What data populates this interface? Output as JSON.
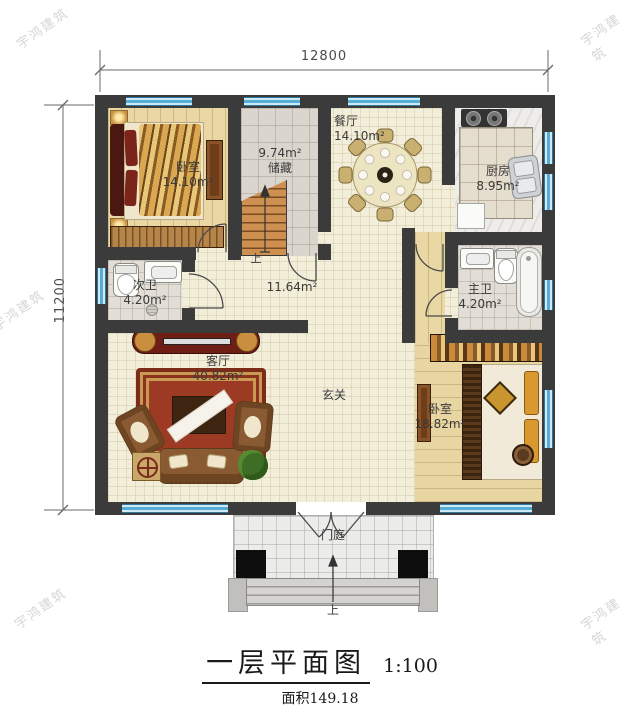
{
  "watermark": {
    "text": "宇鸿建筑"
  },
  "dimensions": {
    "top": "12800",
    "left": "11200"
  },
  "plan": {
    "rooms": {
      "bedroom_top_left": {
        "name": "卧室",
        "area": "14.10m²"
      },
      "storage": {
        "area": "9.74m²",
        "name": "储藏"
      },
      "dining": {
        "name": "餐厅",
        "area": "14.10m²"
      },
      "kitchen": {
        "name": "厨房",
        "area": "8.95m²"
      },
      "bath_secondary": {
        "name": "次卫",
        "area": "4.20m²"
      },
      "hall": {
        "area": "11.64m²"
      },
      "bath_master": {
        "name": "主卫",
        "area": "4.20m²"
      },
      "living": {
        "name": "客厅",
        "area": "40.82m²"
      },
      "foyer": {
        "name": "玄关"
      },
      "bedroom_right": {
        "name": "卧室",
        "area": "18.82m²"
      },
      "porch": {
        "name": "门庭"
      }
    },
    "stairs": {
      "up_label": "上"
    },
    "entrance": {
      "up_label": "上"
    }
  },
  "title": {
    "text": "一层平面图",
    "scale": "1:100",
    "area": "面积149.18"
  },
  "colors": {
    "wall": "#3b3b3b",
    "window_blue": "#56aed6",
    "stair_wood": "#c98e4e",
    "rug_red": "#9c3a24"
  }
}
